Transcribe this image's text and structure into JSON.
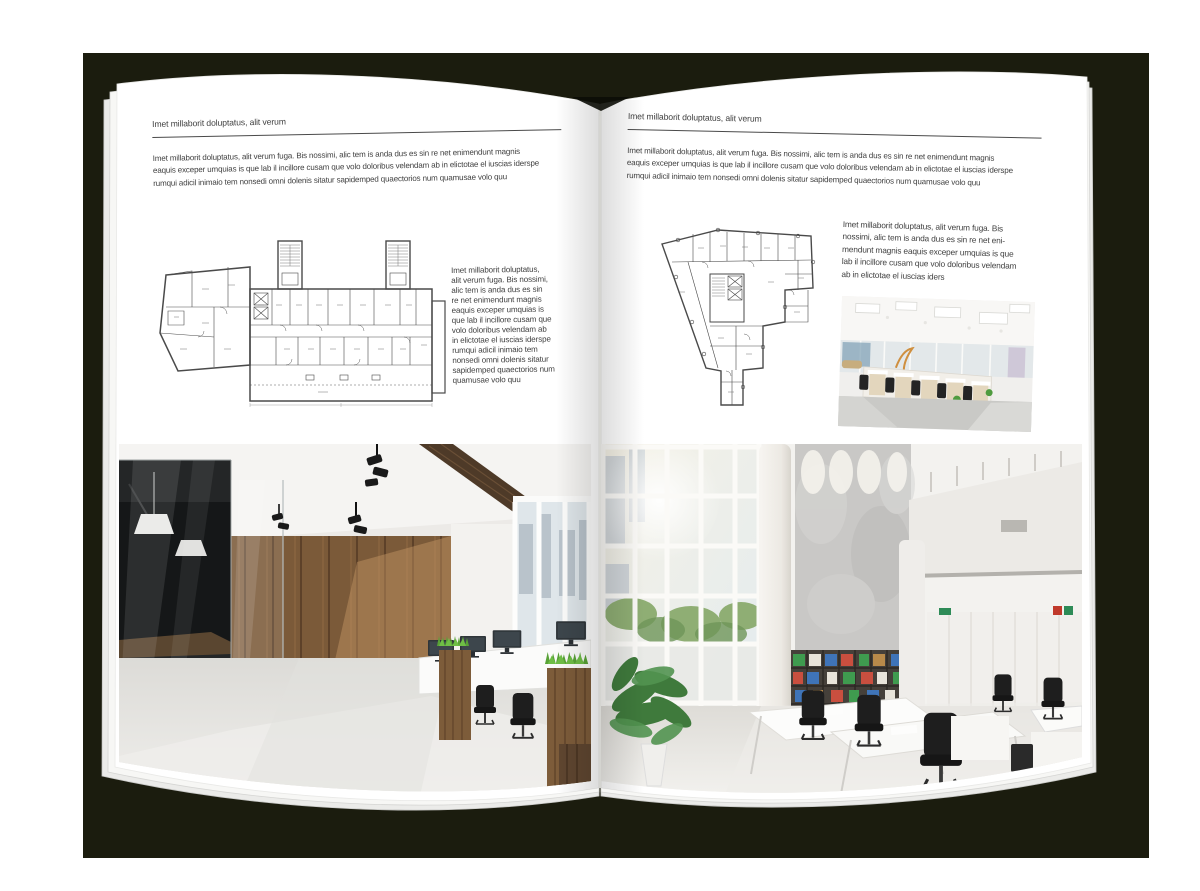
{
  "document": {
    "type": "open-magazine-spread-mockup"
  },
  "colors": {
    "backdrop": "#1b1c0e",
    "page": "#ffffff",
    "text": "#3f3f3f",
    "rule": "#4a4a4a",
    "plan_line": "#4a4a4a",
    "grass_green": "#58a236",
    "chair_green": "#4c6133",
    "wood_wall": "#7b5a39"
  },
  "left_page": {
    "header": "Imet millaborit doluptatus, alit verum",
    "intro_lines": [
      "Imet millaborit doluptatus, alit verum fuga. Bis nossimi, alic tem is anda dus es sin re net enimendunt magnis",
      "eaquis exceper umquias is que lab il incillore cusam que volo doloribus velendam ab in elictotae el iuscias iderspe",
      "rumqui adicil inimaio tem nonsedi omni dolenis sitatur sapidemped quaectorios num quamusae volo quu"
    ],
    "side_lines": [
      "Imet millaborit doluptatus,",
      "alit verum fuga. Bis nossimi,",
      "alic tem is anda dus es sin",
      "re net enimendunt magnis",
      "eaquis exceper umquias is",
      "que lab il incillore cusam que",
      "volo doloribus velendam ab",
      "in elictotae el iuscias iderspe",
      "rumqui adicil inimaio tem",
      "nonsedi omni dolenis sitatur",
      "sapidemped quaectorios num",
      "quamusae volo quu"
    ],
    "plan_alt": "Architectural floor plan of an elongated building with two stair cores",
    "photo_alt": "Loft office with glass meeting room, green chairs, wooden plank wall, workstations and grass planters"
  },
  "right_page": {
    "header": "Imet millaborit doluptatus, alit verum",
    "intro_lines": [
      "Imet millaborit doluptatus, alit verum fuga. Bis nossimi, alic tem is anda dus es sin re net enimendunt magnis",
      "eaquis exceper umquias is que lab il incillore cusam que volo doloribus velendam ab in elictotae el iuscias iderspe",
      "rumqui adicil inimaio tem nonsedi omni dolenis sitatur sapidemped quaectorios num quamusae volo quu"
    ],
    "side_lines": [
      "Imet millaborit doluptatus, alit verum fuga. Bis",
      "nossimi, alic tem is anda dus es sin re net eni-",
      "mendunt magnis eaquis exceper umquias is que",
      "lab il incillore cusam que volo doloribus velendam",
      "ab in elictotae el iuscias iders"
    ],
    "plan_alt": "Architectural floor plan of an irregular wedge-shaped building",
    "photo_small_alt": "Bright open-space office with rows of desks, wooden cabinets and black chairs",
    "photo_alt": "White double-height office with window wall, concrete wall, bookshelf with colorful binders and desks"
  }
}
